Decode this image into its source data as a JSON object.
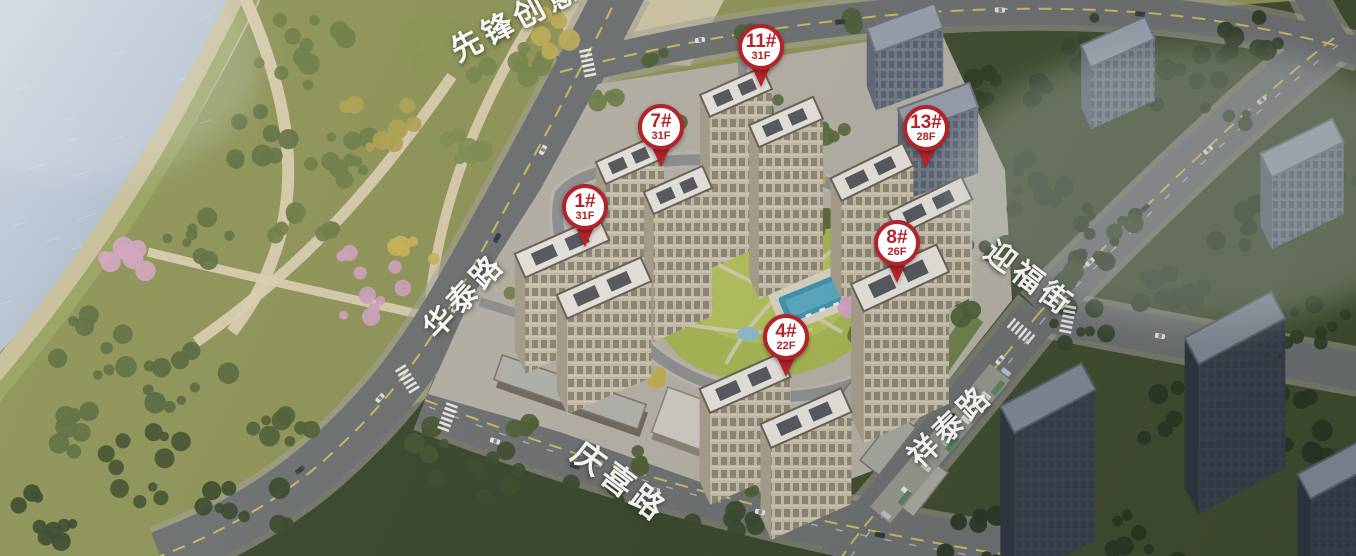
{
  "title": "residential-masterplan-aerial",
  "pins": [
    {
      "label": "1#",
      "floors": "31F",
      "x": 585,
      "y": 207
    },
    {
      "label": "7#",
      "floors": "31F",
      "x": 661,
      "y": 127
    },
    {
      "label": "11#",
      "floors": "31F",
      "x": 761,
      "y": 47
    },
    {
      "label": "13#",
      "floors": "28F",
      "x": 926,
      "y": 128
    },
    {
      "label": "8#",
      "floors": "26F",
      "x": 897,
      "y": 243
    },
    {
      "label": "4#",
      "floors": "22F",
      "x": 786,
      "y": 337
    }
  ],
  "streets": [
    {
      "name": "先锋创意",
      "x": 514,
      "y": 17,
      "rot": -28,
      "size": 31
    },
    {
      "name": "华泰路",
      "x": 462,
      "y": 294,
      "rot": -47,
      "size": 30
    },
    {
      "name": "迎福街",
      "x": 1031,
      "y": 276,
      "rot": 37,
      "size": 30
    },
    {
      "name": "祥泰路",
      "x": 948,
      "y": 424,
      "rot": -44,
      "size": 30
    },
    {
      "name": "庆喜路",
      "x": 621,
      "y": 480,
      "rot": 37,
      "size": 32
    }
  ],
  "colors": {
    "pin_red": "#b2232a",
    "pin_fill": "#ffffff",
    "label_white": "#ffffff",
    "water": "#aab9cd",
    "park_green": "#8d9355",
    "forest_green": "#3e4a2d",
    "road_gray": "#6c6f70",
    "lane_yellow": "#d5c35a",
    "courtyard_lawn": "#a8b650",
    "pool_blue": "#4d9cb8",
    "tower_facade": "#c8bea8",
    "context_tower": "#717a8a"
  }
}
